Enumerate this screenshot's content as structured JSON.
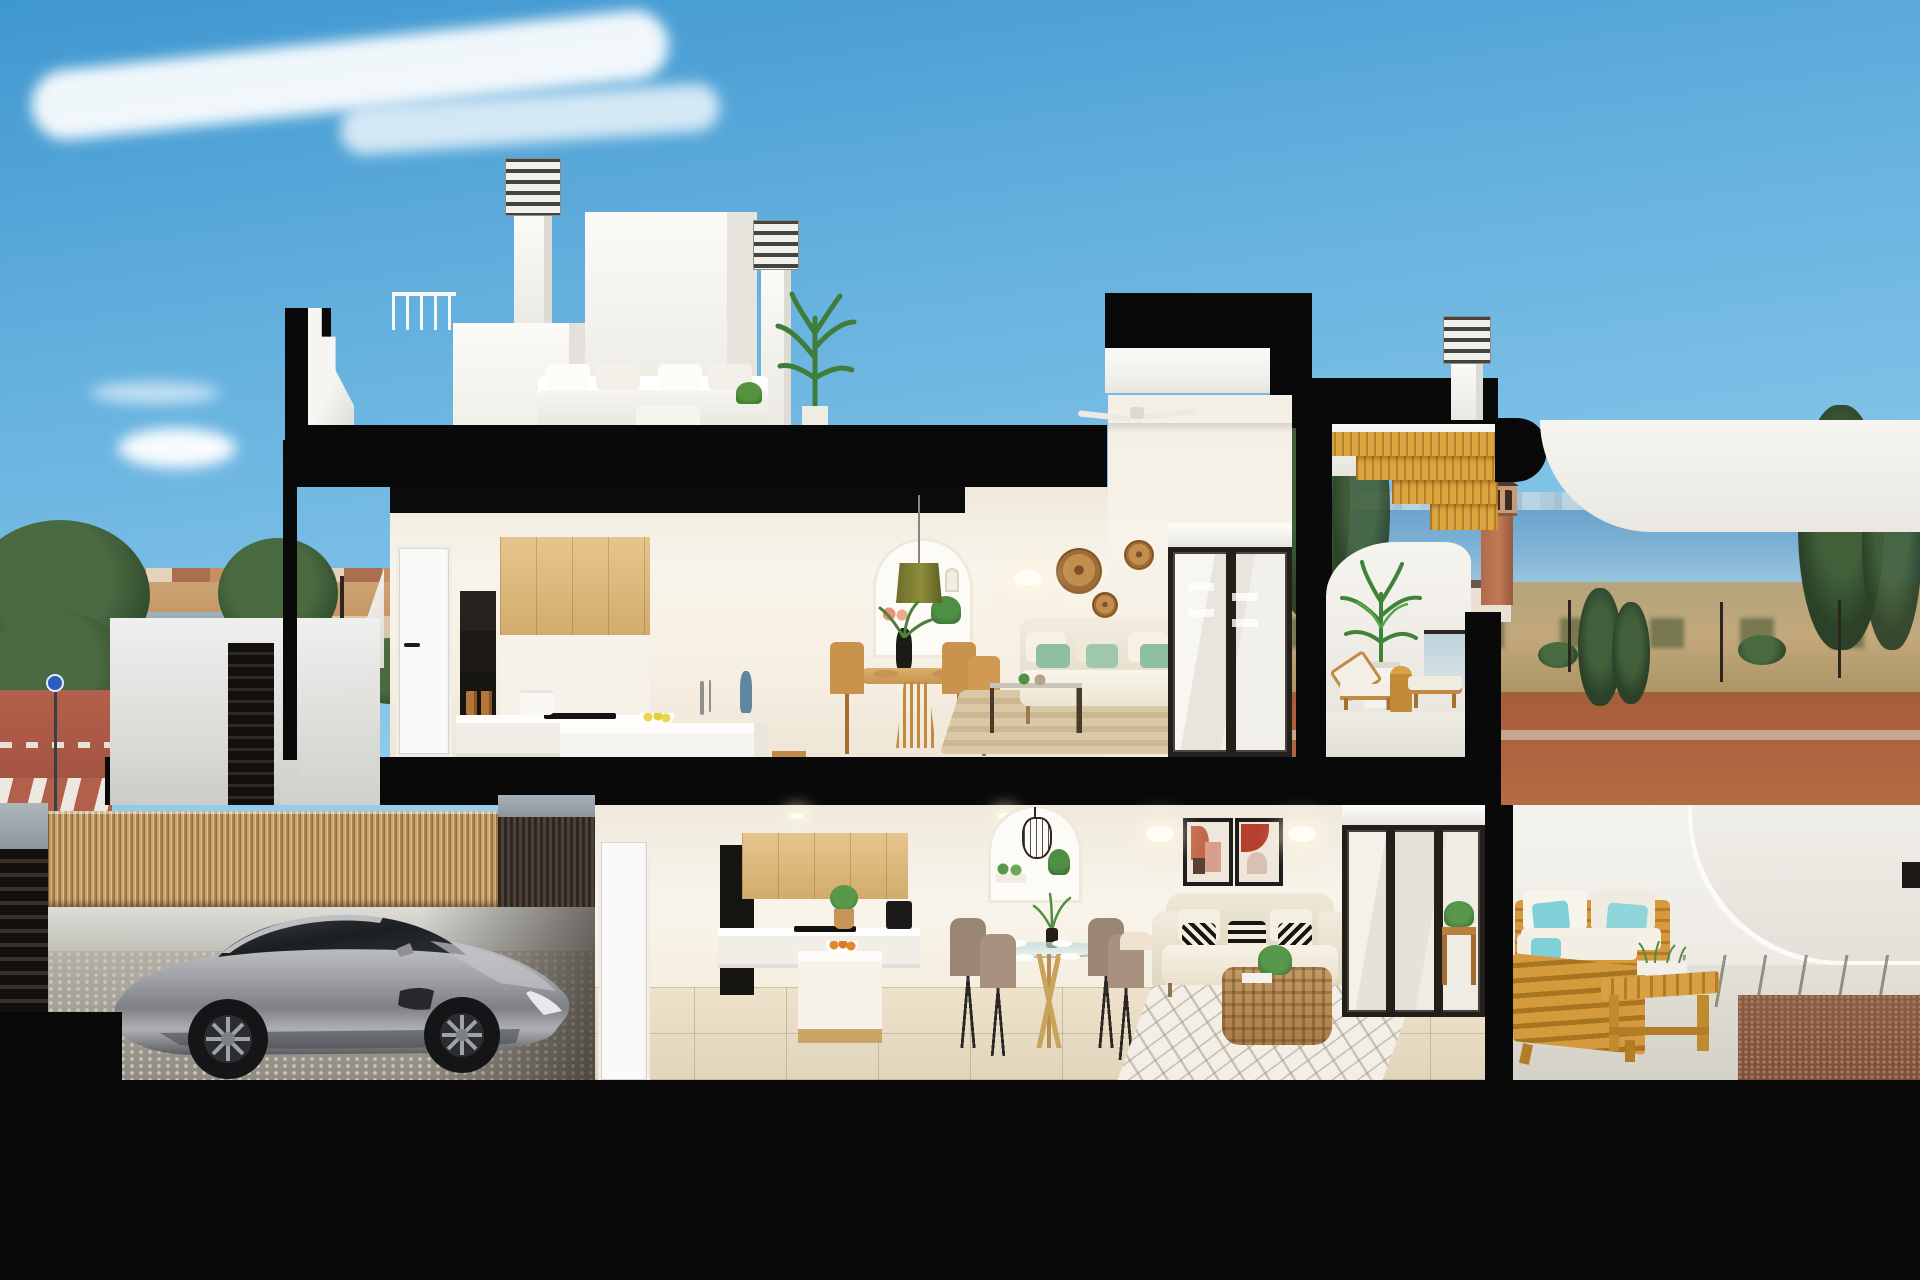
{
  "scene": {
    "title": "3D cutaway cross-section render of a modern two-storey coastal townhouse",
    "environment": "Mediterranean town by the sea, clear blue sky with wispy clouds, dusk light",
    "render_style": "architectural visualization with thick black section cuts",
    "visible_text": "none"
  },
  "palette": {
    "sky_top": "#3f97d0",
    "sky_horizon": "#e2f2f9",
    "section_cut": "#090909",
    "wall_white": "#f5f2ec",
    "interior_warm": "#f8f2e6",
    "cabinet_wood": "#ddba7d",
    "furniture_wood": "#c9924d",
    "outdoor_wood": "#d69a3e",
    "stair_wood": "#d9a23a",
    "floor_tile": "#e7ddc9",
    "cobblestone": "#aca89e",
    "bamboo": "#c8a76d",
    "sea": "#78aed3",
    "dirt_road": "#b2663f",
    "field": "#c3a87c",
    "tree_green": "#33502f",
    "plant_green": "#4e8f43",
    "cushion_green": "#8fbfa3",
    "cushion_aqua": "#7fd0d8",
    "car_silver": "#a9abaf",
    "town_wall": "#cfa578",
    "terracotta_art": "#bf5f3e"
  },
  "background": {
    "clouds": {
      "streak": "long wispy cirrus cloud",
      "puff": "small cumulus cloud",
      "wisp": "thin lens-shaped cloud"
    },
    "town": {
      "label": "low-rise Mediterranean town skyline",
      "apartments": "cream apartment blocks",
      "houses": "terracotta village houses",
      "trees": "dark green pines and street trees",
      "lamp": "street light"
    },
    "street": {
      "label": "street corner",
      "sidewalk": "red paved sidewalk",
      "crosswalk": "zebra crossing",
      "road": "asphalt road",
      "sign": "blue circular traffic sign"
    },
    "coast": {
      "label": "sea horizon with distant skyline",
      "sea": "calm blue sea",
      "skyline": "distant high-rise skyline",
      "mountain": "distant headland mountain",
      "field": "dry scrubland field",
      "dirt": "red-brown unpaved ground",
      "watchtower": "terracotta lookout tower with arched loggia and pyramid roof",
      "cypresses": "tall dark cypress trees",
      "bushes": "low shrubs",
      "lamps": "park lanterns",
      "house": "small white house with dark roof"
    }
  },
  "building": {
    "structure": {
      "cut_walls": "thick black section cut walls",
      "interfloor_slab": "black interfloor slab",
      "ground": "black ground base",
      "roof_slab": "black roof slab",
      "canopy_end": "rounded black canopy end"
    },
    "roof": {
      "chimney_left": "white chimney with louvered cap",
      "chimney_mid": "white chimney with louvered cap",
      "chimney_right": "white chimney with louvered cap",
      "bulkhead": "white stair bulkhead",
      "core": "tall white core volume",
      "railing": "white roof railing",
      "terrace": {
        "label": "roof terrace",
        "sofa": "white outdoor lounge sofa",
        "table": "white coffee table",
        "plant": "tall leafy plant",
        "small_plant": "potted table plant"
      },
      "stairs": "golden wood slat stair flight",
      "canopy": "white curved canopy",
      "parapet": "stepped white parapet"
    },
    "upper_floor": {
      "label": "first-floor apartment",
      "door": "white interior door",
      "kitchen": {
        "label": "kitchen",
        "oven_tower": "black built-in oven column",
        "cabinets": "light oak wall cabinets",
        "counter": "white counter with hob",
        "pot": "white cooking pot",
        "jars": "spice jars",
        "island": "white kitchen island",
        "stools": "two wooden bar stools",
        "faucet": "chrome faucet",
        "vase": "blue bud vase",
        "lemons": "bowl of lemons"
      },
      "dining": {
        "label": "dining area",
        "table": "round oak pedestal table",
        "chairs": "four oak dining chairs",
        "vase": "black vase with green branches",
        "placemats": "rattan placemats"
      },
      "niche": {
        "label": "arched shelf niche",
        "pendant": "olive green pendant lamp",
        "vases": "coral ceramic vases",
        "plant": "trailing ivy plant",
        "ornament": "white arch ornament"
      },
      "living": {
        "label": "living room",
        "fan": "white ceiling fan",
        "baskets": "three rattan wall baskets",
        "sconce_left": "white wall sconce",
        "sconce_right": "white wall sconce",
        "sofa": "cream fabric sofa with sage green cushions",
        "coffee_table": "dark wood and glass coffee table",
        "rug": "striped jute rug",
        "door": "black framed sliding glass door",
        "blind": "white roller blind"
      },
      "terrace": {
        "label": "upper terrace",
        "parapet": "curved white parapet",
        "palm": "potted palm in white planter",
        "lounger_a": "wooden sun lounger with white cushion",
        "lounger_b": "wooden sun lounger with white cushion",
        "side_table": "golden drinks table",
        "balustrade": "glass balustrade"
      }
    },
    "lower_floor": {
      "label": "ground-floor apartment",
      "door": "white interior door",
      "downlights": "recessed ceiling downlights",
      "kitchen": {
        "label": "kitchen",
        "oven_tower": "black built-in oven column",
        "cabinets": "light oak wall cabinets",
        "coffee_machine": "black coffee machine",
        "counter": "white counter with hob",
        "plant": "potted plant in basket",
        "island": "white island with oak side panel",
        "stool": "round wooden stool",
        "oranges": "bowl of oranges"
      },
      "dining": {
        "label": "dining area",
        "table": "round glass dining table",
        "chairs": "four taupe upholstered chairs",
        "plates": "set table with white plates",
        "centerpiece": "leafy centerpiece in dark vase"
      },
      "niche": {
        "label": "arched shelf niche",
        "lantern": "black wire lantern pendant",
        "plants": "small potted plants"
      },
      "living": {
        "label": "living room",
        "art_left": "abstract print in black frame",
        "art_right": "abstract print in black frame",
        "sconce_left": "white wall sconce",
        "sconce_right": "white wall sconce",
        "sofa": "cream loveseat with black and white patterned cushions",
        "basket": "wicker basket with throw blanket",
        "coffee_table": "woven rattan coffee table",
        "plant": "potted green plant",
        "rug": "white diamond-pattern rug",
        "doors": "black framed sliding glass doors",
        "blind": "white roller blind"
      },
      "floor": "large beige stone tiles"
    },
    "garage": {
      "label": "open carport at street level",
      "car": "silver sports coupe",
      "fence": "bamboo reed privacy fence",
      "cap": "concrete wall cap",
      "slat_wall": "dark timber slat wall",
      "floor": "grey cobblestone paving",
      "base": "light concrete wall base"
    },
    "entrance": {
      "label": "street entrance",
      "stairs": "white exterior entry stairs",
      "gate": "dark louvered gate",
      "parapet": "white rendered parapet wall"
    },
    "right_terrace": {
      "label": "neighbouring ground-floor terrace",
      "sofa_front": "timber outdoor sofa seen from behind",
      "sofa_back": "timber outdoor sofa with white cushions",
      "cushions": "aqua outdoor cushions",
      "bench": "timber slat coffee bench",
      "planter": "white trough planter with herbs",
      "side_table": "timber side table with plant",
      "wall": "curved white garden wall",
      "paving": "pale terrace paving",
      "joints": "dark paving joints",
      "gravel": "brown gravel bed",
      "niche": "dark wall niche"
    }
  }
}
